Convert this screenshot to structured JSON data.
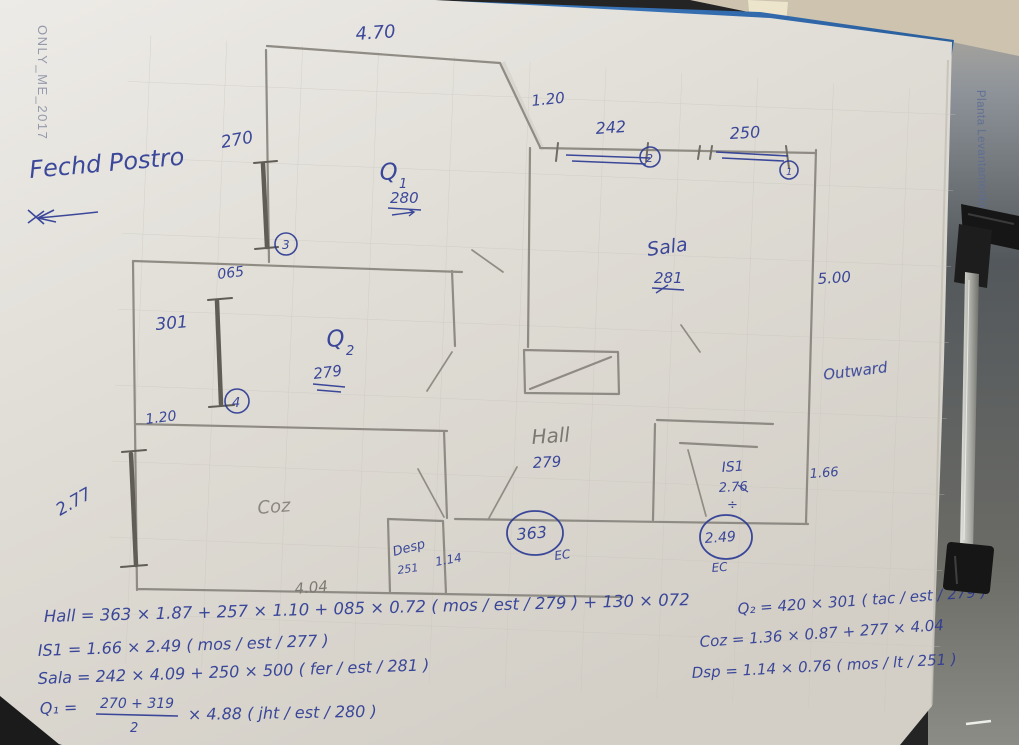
{
  "photo": {
    "watermark": "ONLY_ME_2017",
    "side_label": "Planta Levantamento",
    "clipboard_color": "#3a77bd",
    "paper_color": "#e4e1db",
    "ink_color": "#2c3a94",
    "pencil_color": "#85827a"
  },
  "notes": {
    "header": "Fechd Postro",
    "right_side": "Outward"
  },
  "plan": {
    "rooms": {
      "q1": {
        "name": "Q",
        "index": "1",
        "ceiling": "280"
      },
      "q2": {
        "name": "Q",
        "index": "2",
        "ceiling": "279"
      },
      "sala": {
        "name": "Sala",
        "ceiling": "281"
      },
      "hall": {
        "name": "Hall",
        "ceiling": "279"
      },
      "coz": {
        "name": "Coz"
      },
      "desp": {
        "name": "Desp",
        "ceiling": "251"
      },
      "is1": {
        "name": "IS1",
        "ceiling": "2.76",
        "divide_mark": "÷"
      }
    },
    "measurements": {
      "top_width": "4.70",
      "q1_window": "270",
      "top_offset": "1.20",
      "window2_width": "242",
      "window1_width": "250",
      "sala_side": "5.00",
      "wall_stub": "065",
      "left_window": "301",
      "q2_door": "1.20",
      "coz_window": "2.77",
      "bottom_width": "4.04",
      "desp_width": "1.14",
      "is1_width": "1.66"
    },
    "refs": {
      "r1": "1",
      "r2": "2",
      "r3": "3",
      "r4": "4"
    },
    "door_values": {
      "hall_entry": "363",
      "is1_entry": "2.49",
      "ec_left": "EC",
      "ec_right": "EC"
    }
  },
  "formulas": {
    "hall": "Hall = 363 × 1.87 + 257 × 1.10 + 085 × 0.72 ( mos / est / 279 ) + 130 × 072",
    "is1": "IS1 = 1.66 × 2.49 ( mos / est / 277 )",
    "sala": "Sala = 242 × 4.09 + 250 × 500 ( fer / est / 281 )",
    "q1_lhs": "Q₁ =",
    "q1_numerator": "270 + 319",
    "q1_denominator": "2",
    "q1_rest": "× 4.88 ( jht / est / 280 )",
    "q2": "Q₂ = 420 × 301 ( tac / est / 279 )",
    "coz": "Coz = 1.36 × 0.87 + 277 × 4.04",
    "desp": "Dsp = 1.14 × 0.76 ( mos / lt / 251 )"
  }
}
